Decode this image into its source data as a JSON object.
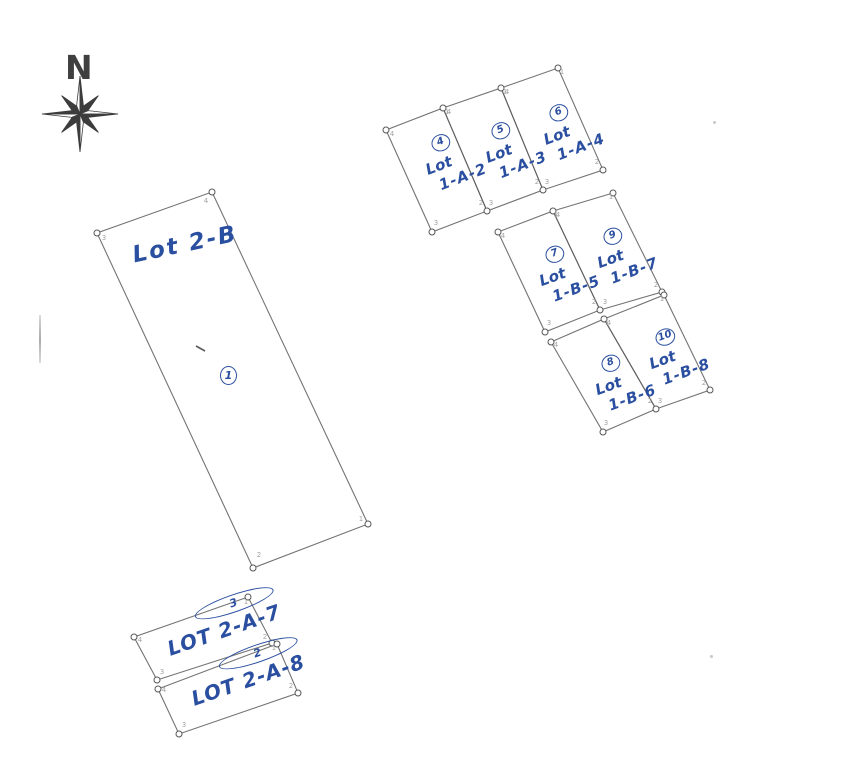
{
  "page": {
    "type_label": "scanned subdivision plat sketch",
    "background": "#ffffff",
    "ink_blue": "#2b4fa0",
    "line_gray": "#5a5a5a",
    "faint_gray": "#a2a2a2"
  },
  "compass": {
    "label": "N"
  },
  "parcels": [
    {
      "id": "lot-2b",
      "word": "Lot",
      "code": "2-B",
      "marker": "1",
      "points": "212,192 368,524 253,568 97,233"
    },
    {
      "id": "lot-2a7",
      "word": "LOT",
      "code": "2-A-7",
      "marker": "3",
      "points": "134,637 248,597 272,643 157,680"
    },
    {
      "id": "lot-2a8",
      "word": "LOT",
      "code": "2-A-8",
      "marker": "2",
      "points": "158,689 277,644 298,693 179,734"
    },
    {
      "id": "lot-1a2",
      "word": "Lot",
      "code": "1-A-2",
      "marker": "4",
      "points": "386,130 443,108 487,211 432,232"
    },
    {
      "id": "lot-1a3",
      "word": "Lot",
      "code": "1-A-3",
      "marker": "5",
      "points": "443,108 501,88 543,190 487,211"
    },
    {
      "id": "lot-1a4",
      "word": "Lot",
      "code": "1-A-4",
      "marker": "6",
      "points": "501,88 558,68 603,170 543,190"
    },
    {
      "id": "lot-1b5",
      "word": "Lot",
      "code": "1-B-5",
      "marker": "7",
      "points": "498,232 553,211 600,310 545,332"
    },
    {
      "id": "lot-1b7",
      "word": "Lot",
      "code": "1-B-7",
      "marker": "9",
      "points": "553,211 613,193 662,292 600,310"
    },
    {
      "id": "lot-1b6",
      "word": "Lot",
      "code": "1-B-6",
      "marker": "8",
      "points": "551,342 604,319 656,409 603,432"
    },
    {
      "id": "lot-1b8",
      "word": "Lot",
      "code": "1-B-8",
      "marker": "10",
      "points": "604,319 664,295 710,390 656,409"
    }
  ],
  "corner_circles": [
    [
      212,
      192
    ],
    [
      368,
      524
    ],
    [
      253,
      568
    ],
    [
      97,
      233
    ],
    [
      386,
      130
    ],
    [
      443,
      108
    ],
    [
      501,
      88
    ],
    [
      558,
      68
    ],
    [
      603,
      170
    ],
    [
      543,
      190
    ],
    [
      487,
      211
    ],
    [
      432,
      232
    ],
    [
      498,
      232
    ],
    [
      553,
      211
    ],
    [
      613,
      193
    ],
    [
      662,
      292
    ],
    [
      600,
      310
    ],
    [
      545,
      332
    ],
    [
      551,
      342
    ],
    [
      604,
      319
    ],
    [
      664,
      295
    ],
    [
      710,
      390
    ],
    [
      656,
      409
    ],
    [
      603,
      432
    ],
    [
      134,
      637
    ],
    [
      248,
      597
    ],
    [
      272,
      643
    ],
    [
      157,
      680
    ],
    [
      158,
      689
    ],
    [
      277,
      644
    ],
    [
      298,
      693
    ],
    [
      179,
      734
    ]
  ],
  "corner_digits": [
    [
      361,
      521,
      "1"
    ],
    [
      259,
      557,
      "2"
    ],
    [
      104,
      240,
      "3"
    ],
    [
      206,
      203,
      "4"
    ],
    [
      447,
      114,
      "1"
    ],
    [
      481,
      205,
      "2"
    ],
    [
      436,
      225,
      "3"
    ],
    [
      392,
      136,
      "4"
    ],
    [
      505,
      94,
      "1"
    ],
    [
      537,
      184,
      "2"
    ],
    [
      491,
      205,
      "3"
    ],
    [
      449,
      114,
      "4"
    ],
    [
      562,
      74,
      "1"
    ],
    [
      597,
      164,
      "2"
    ],
    [
      547,
      184,
      "3"
    ],
    [
      507,
      94,
      "4"
    ],
    [
      556,
      217,
      "1"
    ],
    [
      594,
      304,
      "2"
    ],
    [
      549,
      325,
      "3"
    ],
    [
      503,
      238,
      "4"
    ],
    [
      611,
      199,
      "1"
    ],
    [
      656,
      287,
      "2"
    ],
    [
      605,
      304,
      "3"
    ],
    [
      558,
      217,
      "4"
    ],
    [
      607,
      325,
      "1"
    ],
    [
      650,
      403,
      "2"
    ],
    [
      606,
      425,
      "3"
    ],
    [
      556,
      347,
      "4"
    ],
    [
      662,
      301,
      "1"
    ],
    [
      704,
      385,
      "2"
    ],
    [
      660,
      403,
      "3"
    ],
    [
      609,
      325,
      "4"
    ],
    [
      246,
      604,
      "1"
    ],
    [
      265,
      639,
      "2"
    ],
    [
      162,
      674,
      "3"
    ],
    [
      140,
      642,
      "4"
    ],
    [
      274,
      650,
      "1"
    ],
    [
      291,
      688,
      "2"
    ],
    [
      184,
      727,
      "3"
    ],
    [
      164,
      692,
      "4"
    ]
  ]
}
